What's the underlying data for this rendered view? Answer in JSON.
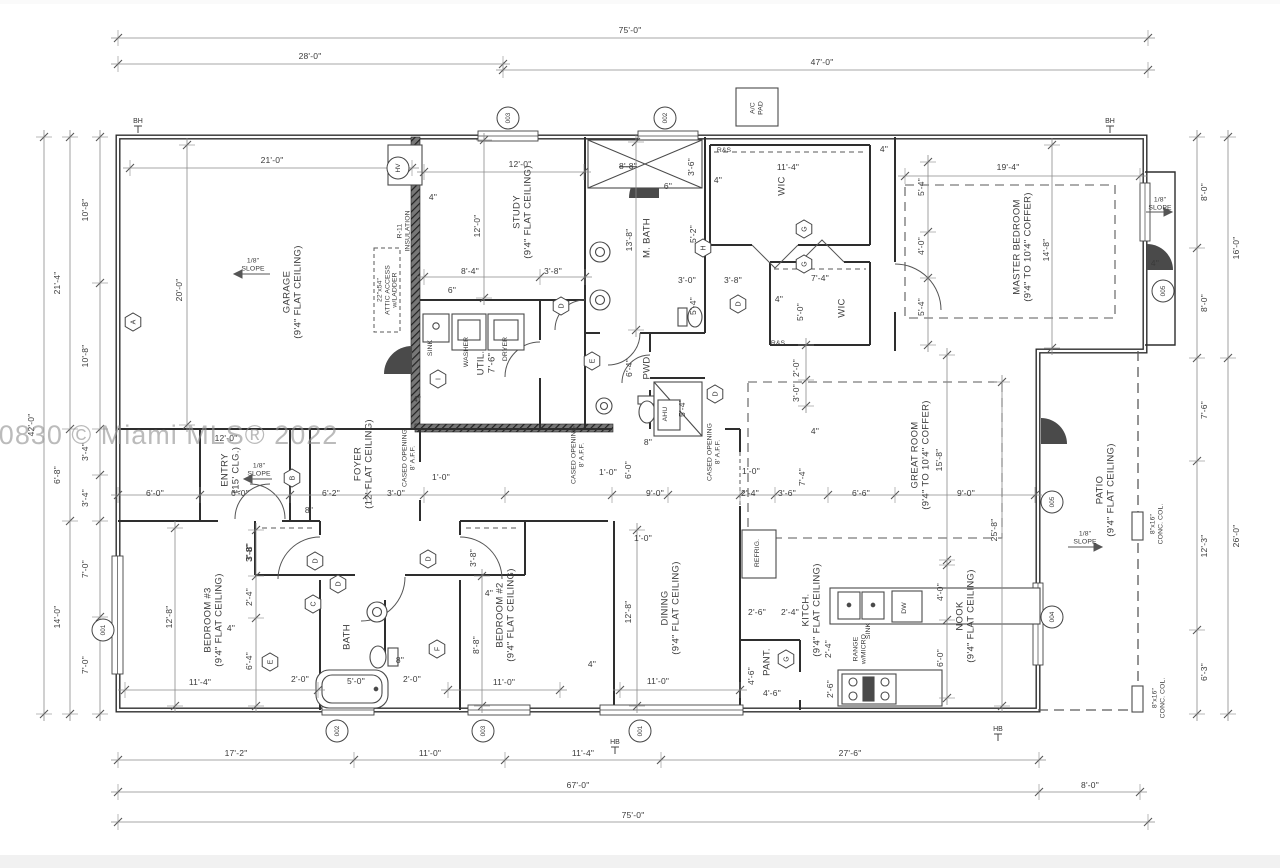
{
  "watermark": "A11290830 © Miami MLS® 2022",
  "colors": {
    "wall": "#2e2e2e",
    "fixture": "#4a4a4a",
    "dim": "#8a8a8a",
    "dash": "#5a5a5a",
    "text": "#3a3a3a",
    "wedge": "#4a4a4a"
  },
  "texts": [
    {
      "n": "dim-top-75",
      "t": "75'-0\"",
      "x": 630,
      "y": 31
    },
    {
      "n": "dim-top-28",
      "t": "28'-0\"",
      "x": 310,
      "y": 57
    },
    {
      "n": "dim-top-47",
      "t": "47'-0\"",
      "x": 822,
      "y": 63
    },
    {
      "n": "dim-bot-17-2",
      "t": "17'-2\"",
      "x": 236,
      "y": 754
    },
    {
      "n": "dim-bot-11-0",
      "t": "11'-0\"",
      "x": 430,
      "y": 754
    },
    {
      "n": "dim-bot-11-4",
      "t": "11'-4\"",
      "x": 583,
      "y": 754
    },
    {
      "n": "dim-bot-27-6",
      "t": "27'-6\"",
      "x": 850,
      "y": 754
    },
    {
      "n": "dim-bot-8-0",
      "t": "8'-0\"",
      "x": 1090,
      "y": 786
    },
    {
      "n": "dim-bot-67",
      "t": "67'-0\"",
      "x": 578,
      "y": 786
    },
    {
      "n": "dim-bot-75",
      "t": "75'-0\"",
      "x": 633,
      "y": 816
    },
    {
      "n": "dim-left-10-8a",
      "t": "10'-8\"",
      "x": 86,
      "y": 210,
      "r": 1
    },
    {
      "n": "dim-left-10-8b",
      "t": "10'-8\"",
      "x": 86,
      "y": 356,
      "r": 1
    },
    {
      "n": "dim-left-3-4a",
      "t": "3'-4\"",
      "x": 86,
      "y": 452,
      "r": 1
    },
    {
      "n": "dim-left-3-4b",
      "t": "3'-4\"",
      "x": 86,
      "y": 498,
      "r": 1
    },
    {
      "n": "dim-left-7-0a",
      "t": "7'-0\"",
      "x": 86,
      "y": 569,
      "r": 1
    },
    {
      "n": "dim-left-7-0b",
      "t": "7'-0\"",
      "x": 86,
      "y": 665,
      "r": 1
    },
    {
      "n": "dim-left-21-4",
      "t": "21'-4\"",
      "x": 58,
      "y": 283,
      "r": 1
    },
    {
      "n": "dim-left-6-8",
      "t": "6'-8\"",
      "x": 58,
      "y": 475,
      "r": 1
    },
    {
      "n": "dim-left-14-0",
      "t": "14'-0\"",
      "x": 58,
      "y": 617,
      "r": 1
    },
    {
      "n": "dim-left-42-0",
      "t": "42'-0\"",
      "x": 32,
      "y": 425,
      "r": 1
    },
    {
      "n": "dim-right-8-0a",
      "t": "8'-0\"",
      "x": 1205,
      "y": 192,
      "r": 1
    },
    {
      "n": "dim-right-8-0b",
      "t": "8'-0\"",
      "x": 1205,
      "y": 303,
      "r": 1
    },
    {
      "n": "dim-right-16-0",
      "t": "16'-0\"",
      "x": 1237,
      "y": 248,
      "r": 1
    },
    {
      "n": "dim-right-7-6",
      "t": "7'-6\"",
      "x": 1205,
      "y": 410,
      "r": 1
    },
    {
      "n": "dim-right-12-3",
      "t": "12'-3\"",
      "x": 1205,
      "y": 546,
      "r": 1
    },
    {
      "n": "dim-right-6-3",
      "t": "6'-3\"",
      "x": 1205,
      "y": 672,
      "r": 1
    },
    {
      "n": "dim-right-26-0",
      "t": "26'-0\"",
      "x": 1237,
      "y": 536,
      "r": 1
    },
    {
      "n": "dim-garage-21-0",
      "t": "21'-0\"",
      "x": 272,
      "y": 161
    },
    {
      "n": "dim-garage-20-0",
      "t": "20'-0\"",
      "x": 180,
      "y": 290,
      "r": 1
    },
    {
      "n": "room-garage",
      "t": "GARAGE\n(9'4\" FLAT CEILING)",
      "x": 293,
      "y": 292,
      "r": 1,
      "k": "r"
    },
    {
      "n": "label-slope-garage",
      "t": "1/8\"\nSLOPE",
      "x": 253,
      "y": 265,
      "k": "s"
    },
    {
      "n": "label-r11",
      "t": "R-11\nINSULATION",
      "x": 404,
      "y": 231,
      "r": 1,
      "k": "s"
    },
    {
      "n": "label-attic",
      "t": "22\"x54\"\nATTIC ACCESS\nw/LADDER",
      "x": 388,
      "y": 290,
      "r": 1,
      "k": "s"
    },
    {
      "n": "dim-4in-garage",
      "t": "4\"",
      "x": 433,
      "y": 198
    },
    {
      "n": "dim-study-12-0a",
      "t": "12'-0\"",
      "x": 520,
      "y": 165
    },
    {
      "n": "dim-study-12-0b",
      "t": "12'-0\"",
      "x": 478,
      "y": 226,
      "r": 1
    },
    {
      "n": "room-study",
      "t": "STUDY\n(9'4\" FLAT CEILING)",
      "x": 523,
      "y": 212,
      "r": 1,
      "k": "r"
    },
    {
      "n": "dim-study-8-4",
      "t": "8'-4\"",
      "x": 470,
      "y": 272
    },
    {
      "n": "dim-study-3-8",
      "t": "3'-8\"",
      "x": 553,
      "y": 272
    },
    {
      "n": "dim-study-6",
      "t": "6\"",
      "x": 452,
      "y": 291
    },
    {
      "n": "dim-shower-8-8",
      "t": "8'-8\"",
      "x": 628,
      "y": 167,
      "st": 1
    },
    {
      "n": "dim-shower-3-6",
      "t": "3'-6\"",
      "x": 692,
      "y": 167,
      "r": 1
    },
    {
      "n": "dim-shower-6",
      "t": "6\"",
      "x": 668,
      "y": 187
    },
    {
      "n": "room-mbath",
      "t": "M. BATH",
      "x": 648,
      "y": 238,
      "r": 1,
      "k": "r"
    },
    {
      "n": "dim-mbath-13-8",
      "t": "13'-8\"",
      "x": 630,
      "y": 240,
      "r": 1
    },
    {
      "n": "dim-mbath-5-2",
      "t": "5'-2\"",
      "x": 694,
      "y": 234,
      "r": 1
    },
    {
      "n": "dim-mbath-3-0",
      "t": "3'-0\"",
      "x": 687,
      "y": 281
    },
    {
      "n": "dim-hall-3-8",
      "t": "3'-8\"",
      "x": 733,
      "y": 281
    },
    {
      "n": "dim-wc-5-4",
      "t": "5'-4\"",
      "x": 694,
      "y": 306,
      "r": 1
    },
    {
      "n": "room-pwd",
      "t": "PWD",
      "x": 648,
      "y": 368,
      "r": 1,
      "k": "r"
    },
    {
      "n": "dim-pwd-6-4",
      "t": "6'-4\"",
      "x": 630,
      "y": 368,
      "r": 1
    },
    {
      "n": "label-ahu",
      "t": "AHU",
      "x": 666,
      "y": 414,
      "r": 1,
      "k": "s"
    },
    {
      "n": "dim-ahu-5-4",
      "t": "5'-4\"",
      "x": 683,
      "y": 408,
      "r": 1
    },
    {
      "n": "label-rs-wic1",
      "t": "R&S",
      "x": 724,
      "y": 151,
      "k": "s"
    },
    {
      "n": "room-wic1",
      "t": "WIC",
      "x": 783,
      "y": 186,
      "r": 1,
      "k": "r"
    },
    {
      "n": "dim-wic1-11-4",
      "t": "11'-4\"",
      "x": 788,
      "y": 168
    },
    {
      "n": "dim-wic1-4",
      "t": "4\"",
      "x": 718,
      "y": 181
    },
    {
      "n": "dim-wic2-7-4",
      "t": "7'-4\"",
      "x": 820,
      "y": 279
    },
    {
      "n": "room-wic2",
      "t": "WIC",
      "x": 843,
      "y": 308,
      "r": 1,
      "k": "r"
    },
    {
      "n": "dim-wic2-5-0",
      "t": "5'-0\"",
      "x": 801,
      "y": 312,
      "r": 1
    },
    {
      "n": "dim-wic2-4",
      "t": "4\"",
      "x": 779,
      "y": 300
    },
    {
      "n": "label-rs-wic2",
      "t": "R&S",
      "x": 778,
      "y": 344,
      "k": "s"
    },
    {
      "n": "dim-gr-2-0",
      "t": "2'-0\"",
      "x": 797,
      "y": 368,
      "r": 1
    },
    {
      "n": "dim-gr-3-0",
      "t": "3'-0\"",
      "x": 797,
      "y": 393,
      "r": 1
    },
    {
      "n": "dim-master-19-4",
      "t": "19'-4\"",
      "x": 1008,
      "y": 168
    },
    {
      "n": "dim-master-4",
      "t": "4\"",
      "x": 884,
      "y": 150
    },
    {
      "n": "room-master",
      "t": "MASTER BEDROOM\n(9'4\" TO 10'4\" COFFER)",
      "x": 1023,
      "y": 247,
      "r": 1,
      "k": "r"
    },
    {
      "n": "dim-master-5-4a",
      "t": "5'-4\"",
      "x": 922,
      "y": 187,
      "r": 1
    },
    {
      "n": "dim-master-4-0",
      "t": "4'-0\"",
      "x": 922,
      "y": 246,
      "r": 1
    },
    {
      "n": "dim-master-5-4b",
      "t": "5'-4\"",
      "x": 922,
      "y": 307,
      "r": 1
    },
    {
      "n": "dim-master-14-8",
      "t": "14'-8\"",
      "x": 1047,
      "y": 250,
      "r": 1
    },
    {
      "n": "label-slope-porch",
      "t": "1/8\"\nSLOPE",
      "x": 1160,
      "y": 204,
      "k": "s"
    },
    {
      "n": "dim-porch-4",
      "t": "4\"",
      "x": 1155,
      "y": 264
    },
    {
      "n": "label-acpad",
      "t": "A/C\nPAD",
      "x": 757,
      "y": 108,
      "r": 1,
      "k": "s"
    },
    {
      "n": "dim-hall-4",
      "t": "4\"",
      "x": 815,
      "y": 432
    },
    {
      "n": "dim-entry-12-0",
      "t": "12'-0\"",
      "x": 226,
      "y": 439
    },
    {
      "n": "room-entry",
      "t": "ENTRY\n(15' CLG.)",
      "x": 231,
      "y": 470,
      "r": 1,
      "k": "r"
    },
    {
      "n": "label-slope-entry",
      "t": "1/8\"\nSLOPE",
      "x": 259,
      "y": 470,
      "k": "s"
    },
    {
      "n": "room-foyer",
      "t": "FOYER\n(12' FLAT CEILING)",
      "x": 364,
      "y": 464,
      "r": 1,
      "k": "r"
    },
    {
      "n": "label-cased1",
      "t": "CASED OPENING\n8' A.F.F.",
      "x": 409,
      "y": 458,
      "r": 1,
      "k": "s"
    },
    {
      "n": "dim-row-6-0a",
      "t": "6'-0\"",
      "x": 155,
      "y": 494
    },
    {
      "n": "dim-row-6-0b",
      "t": "6'-0\"",
      "x": 240,
      "y": 494
    },
    {
      "n": "dim-row-6-2",
      "t": "6'-2\"",
      "x": 331,
      "y": 494
    },
    {
      "n": "dim-row-3-0",
      "t": "3'-0\"",
      "x": 396,
      "y": 494
    },
    {
      "n": "dim-row-8in",
      "t": "8\"",
      "x": 309,
      "y": 511
    },
    {
      "n": "dim-row-1-0a",
      "t": "1'-0\"",
      "x": 441,
      "y": 478
    },
    {
      "n": "dim-hall2-3-8",
      "t": "3'-8\"",
      "x": 250,
      "y": 552,
      "r": 1
    },
    {
      "n": "dim-din-8in",
      "t": "8\"",
      "x": 648,
      "y": 443
    },
    {
      "n": "label-cased2",
      "t": "CASED OPENING\n8' A.F.F.",
      "x": 578,
      "y": 455,
      "r": 1,
      "k": "s"
    },
    {
      "n": "label-cased3",
      "t": "CASED OPENING\n8' A.F.F.",
      "x": 714,
      "y": 452,
      "r": 1,
      "k": "s"
    },
    {
      "n": "dim-din-6-0",
      "t": "6'-0\"",
      "x": 629,
      "y": 470,
      "r": 1
    },
    {
      "n": "dim-din-1-0a",
      "t": "1'-0\"",
      "x": 608,
      "y": 473
    },
    {
      "n": "dim-row-9-0a",
      "t": "9'-0\"",
      "x": 655,
      "y": 494
    },
    {
      "n": "dim-row-1-0b",
      "t": "1'-0\"",
      "x": 751,
      "y": 472
    },
    {
      "n": "dim-row-2-4",
      "t": "2'-4\"",
      "x": 750,
      "y": 494
    },
    {
      "n": "dim-row-3-6",
      "t": "3'-6\"",
      "x": 787,
      "y": 494
    },
    {
      "n": "dim-row-6-6",
      "t": "6'-6\"",
      "x": 861,
      "y": 494
    },
    {
      "n": "dim-row-9-0b",
      "t": "9'-0\"",
      "x": 966,
      "y": 494
    },
    {
      "n": "dim-gr-7-4",
      "t": "7'-4\"",
      "x": 803,
      "y": 477,
      "r": 1
    },
    {
      "n": "room-great",
      "t": "GREAT ROOM\n(9'4\" TO 10'4\" COFFER)",
      "x": 921,
      "y": 455,
      "r": 1,
      "k": "r"
    },
    {
      "n": "dim-great-15-8",
      "t": "15'-8\"",
      "x": 940,
      "y": 460,
      "r": 1
    },
    {
      "n": "dim-great-25-8",
      "t": "25'-8\"",
      "x": 995,
      "y": 530,
      "r": 1
    },
    {
      "n": "dim-din-1-0c",
      "t": "1'-0\"",
      "x": 643,
      "y": 539
    },
    {
      "n": "room-dining",
      "t": "DINING\n(9'4\" FLAT CEILING)",
      "x": 671,
      "y": 608,
      "r": 1,
      "k": "r"
    },
    {
      "n": "dim-dining-12-8",
      "t": "12'-8\"",
      "x": 629,
      "y": 612,
      "r": 1
    },
    {
      "n": "dim-dining-11-0",
      "t": "11'-0\"",
      "x": 658,
      "y": 682
    },
    {
      "n": "dim-dining-4",
      "t": "4\"",
      "x": 592,
      "y": 665
    },
    {
      "n": "label-refrig",
      "t": "REFRIG.",
      "x": 758,
      "y": 553,
      "r": 1,
      "k": "s"
    },
    {
      "n": "dim-kit-2-6a",
      "t": "2'-6\"",
      "x": 757,
      "y": 613
    },
    {
      "n": "dim-kit-2-4a",
      "t": "2'-4\"",
      "x": 790,
      "y": 613
    },
    {
      "n": "room-kitch",
      "t": "KITCH.\n(9'4\" FLAT CEILING)",
      "x": 812,
      "y": 610,
      "r": 1,
      "k": "r"
    },
    {
      "n": "label-sink-kitchen",
      "t": "SINK",
      "x": 869,
      "y": 631,
      "r": 1,
      "k": "s"
    },
    {
      "n": "label-dw",
      "t": "DW",
      "x": 905,
      "y": 608,
      "r": 1,
      "k": "s"
    },
    {
      "n": "label-range",
      "t": "RANGE\nw/MICRO",
      "x": 860,
      "y": 649,
      "r": 1,
      "k": "s"
    },
    {
      "n": "dim-nook-4-0",
      "t": "4'-0\"",
      "x": 941,
      "y": 592,
      "r": 1
    },
    {
      "n": "dim-nook-6-0",
      "t": "6'-0\"",
      "x": 941,
      "y": 658,
      "r": 1
    },
    {
      "n": "room-nook",
      "t": "NOOK\n(9'4\" FLAT CEILING)",
      "x": 966,
      "y": 616,
      "r": 1,
      "k": "r"
    },
    {
      "n": "room-pant",
      "t": "PANT.",
      "x": 768,
      "y": 662,
      "r": 1,
      "k": "r"
    },
    {
      "n": "dim-pant-4-6a",
      "t": "4'-6\"",
      "x": 752,
      "y": 676,
      "r": 1
    },
    {
      "n": "dim-pant-4-6b",
      "t": "4'-6\"",
      "x": 772,
      "y": 694
    },
    {
      "n": "dim-kit-2-4b",
      "t": "2'-4\"",
      "x": 829,
      "y": 649,
      "r": 1
    },
    {
      "n": "dim-kit-2-6b",
      "t": "2'-6\"",
      "x": 831,
      "y": 689,
      "r": 1
    },
    {
      "n": "room-patio",
      "t": "PATIO\n(9'4\" FLAT CEILING)",
      "x": 1106,
      "y": 490,
      "r": 1,
      "k": "r"
    },
    {
      "n": "label-slope-patio",
      "t": "1/8\"\nSLOPE",
      "x": 1085,
      "y": 538,
      "k": "s"
    },
    {
      "n": "label-conc-col1",
      "t": "8\"x16\"\nCONC. COL.",
      "x": 1157,
      "y": 524,
      "r": 1,
      "k": "s"
    },
    {
      "n": "label-conc-col2",
      "t": "8\"x16\"\nCONC. COL.",
      "x": 1159,
      "y": 698,
      "r": 1,
      "k": "s"
    },
    {
      "n": "room-bed3",
      "t": "BEDROOM #3\n(9'4\" FLAT CEILING)",
      "x": 214,
      "y": 620,
      "r": 1,
      "k": "r"
    },
    {
      "n": "dim-bed3-12-8",
      "t": "12'-8\"",
      "x": 170,
      "y": 617,
      "r": 1
    },
    {
      "n": "dim-bed3-11-4",
      "t": "11'-4\"",
      "x": 200,
      "y": 683
    },
    {
      "n": "dim-cl3-3-8",
      "t": "3'-8\"",
      "x": 250,
      "y": 553,
      "r": 1
    },
    {
      "n": "dim-cl3-2-4",
      "t": "2'-4\"",
      "x": 250,
      "y": 597,
      "r": 1
    },
    {
      "n": "dim-cl3-6-4",
      "t": "6'-4\"",
      "x": 250,
      "y": 661,
      "r": 1
    },
    {
      "n": "dim-cl3-4",
      "t": "4\"",
      "x": 231,
      "y": 629
    },
    {
      "n": "dim-cl3-2-0",
      "t": "2'-0\"",
      "x": 300,
      "y": 680
    },
    {
      "n": "room-bath2",
      "t": "BATH",
      "x": 348,
      "y": 637,
      "r": 1,
      "k": "r"
    },
    {
      "n": "dim-bath2-5-0",
      "t": "5'-0\"",
      "x": 356,
      "y": 682
    },
    {
      "n": "dim-bath2-8in",
      "t": "8\"",
      "x": 400,
      "y": 661
    },
    {
      "n": "dim-cl2-2-0",
      "t": "2'-0\"",
      "x": 412,
      "y": 680
    },
    {
      "n": "dim-bed2-3-8",
      "t": "3'-8\"",
      "x": 474,
      "y": 558,
      "r": 1
    },
    {
      "n": "dim-bed2-4",
      "t": "4\"",
      "x": 489,
      "y": 594
    },
    {
      "n": "dim-bed2-8-8",
      "t": "8'-8\"",
      "x": 477,
      "y": 645,
      "r": 1
    },
    {
      "n": "room-bed2",
      "t": "BEDROOM #2\n(9'4\" FLAT CEILING)",
      "x": 506,
      "y": 615,
      "r": 1,
      "k": "r"
    },
    {
      "n": "dim-bed2-11-0",
      "t": "11'-0\"",
      "x": 504,
      "y": 683
    },
    {
      "n": "room-util",
      "t": "UTIL.\n7'-6\"",
      "x": 487,
      "y": 363,
      "r": 1,
      "k": "r"
    },
    {
      "n": "label-sink-util",
      "t": "SINK",
      "x": 431,
      "y": 348,
      "r": 1,
      "k": "s"
    },
    {
      "n": "label-washer",
      "t": "WASHER",
      "x": 467,
      "y": 352,
      "r": 1,
      "k": "s"
    },
    {
      "n": "label-dryer",
      "t": "DRYER",
      "x": 506,
      "y": 349,
      "r": 1,
      "k": "s"
    },
    {
      "n": "dim-util-4",
      "t": "4\"",
      "x": 417,
      "y": 400
    }
  ],
  "markers": {
    "hex": [
      {
        "l": "A",
        "x": 133,
        "y": 322
      },
      {
        "l": "B",
        "x": 292,
        "y": 478
      },
      {
        "l": "D",
        "x": 561,
        "y": 306
      },
      {
        "l": "I",
        "x": 438,
        "y": 379
      },
      {
        "l": "E",
        "x": 592,
        "y": 361
      },
      {
        "l": "H",
        "x": 703,
        "y": 248
      },
      {
        "l": "D",
        "x": 738,
        "y": 304
      },
      {
        "l": "G",
        "x": 804,
        "y": 229
      },
      {
        "l": "G",
        "x": 804,
        "y": 264
      },
      {
        "l": "D",
        "x": 715,
        "y": 394
      },
      {
        "l": "C",
        "x": 313,
        "y": 604
      },
      {
        "l": "D",
        "x": 315,
        "y": 561
      },
      {
        "l": "D",
        "x": 338,
        "y": 584
      },
      {
        "l": "D",
        "x": 428,
        "y": 559
      },
      {
        "l": "E",
        "x": 270,
        "y": 662
      },
      {
        "l": "F",
        "x": 437,
        "y": 649
      },
      {
        "l": "G",
        "x": 786,
        "y": 659
      }
    ],
    "circ": [
      {
        "t": "001",
        "x": 103,
        "y": 630
      },
      {
        "t": "002",
        "x": 337,
        "y": 731
      },
      {
        "t": "003",
        "x": 483,
        "y": 731
      },
      {
        "t": "001",
        "x": 640,
        "y": 731
      },
      {
        "t": "003",
        "x": 508,
        "y": 118
      },
      {
        "t": "002",
        "x": 665,
        "y": 118
      },
      {
        "t": "005",
        "x": 1163,
        "y": 291
      },
      {
        "t": "005",
        "x": 1052,
        "y": 502
      },
      {
        "t": "004",
        "x": 1052,
        "y": 617
      },
      {
        "t": "HV",
        "x": 398,
        "y": 168
      }
    ],
    "hb": [
      {
        "t": "BH",
        "x": 138,
        "y": 121
      },
      {
        "t": "BH",
        "x": 1110,
        "y": 121
      },
      {
        "t": "HB",
        "x": 615,
        "y": 742
      },
      {
        "t": "HB",
        "x": 998,
        "y": 729
      }
    ]
  }
}
